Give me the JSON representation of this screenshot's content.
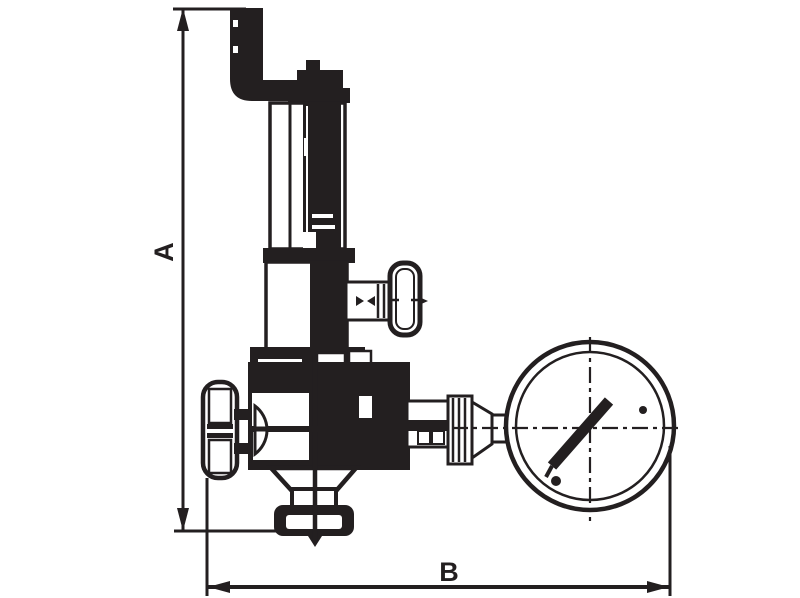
{
  "drawing": {
    "kind": "technical-line-drawing",
    "background": "#ffffff",
    "line_color": "#231f20",
    "labels": {
      "a": "A",
      "b": "B"
    },
    "dimensions": [
      {
        "label": "A",
        "orientation": "vertical"
      },
      {
        "label": "B",
        "orientation": "horizontal"
      }
    ],
    "parts": [
      "inlet-pipe",
      "spring-housing",
      "adjusting-screw",
      "bonnet-flange",
      "upper-body",
      "side-shutoff-valve",
      "t-handle",
      "handwheel",
      "main-valve-body",
      "bottom-outlet-flange",
      "gauge-fitting",
      "pressure-gauge",
      "gauge-needle"
    ]
  }
}
